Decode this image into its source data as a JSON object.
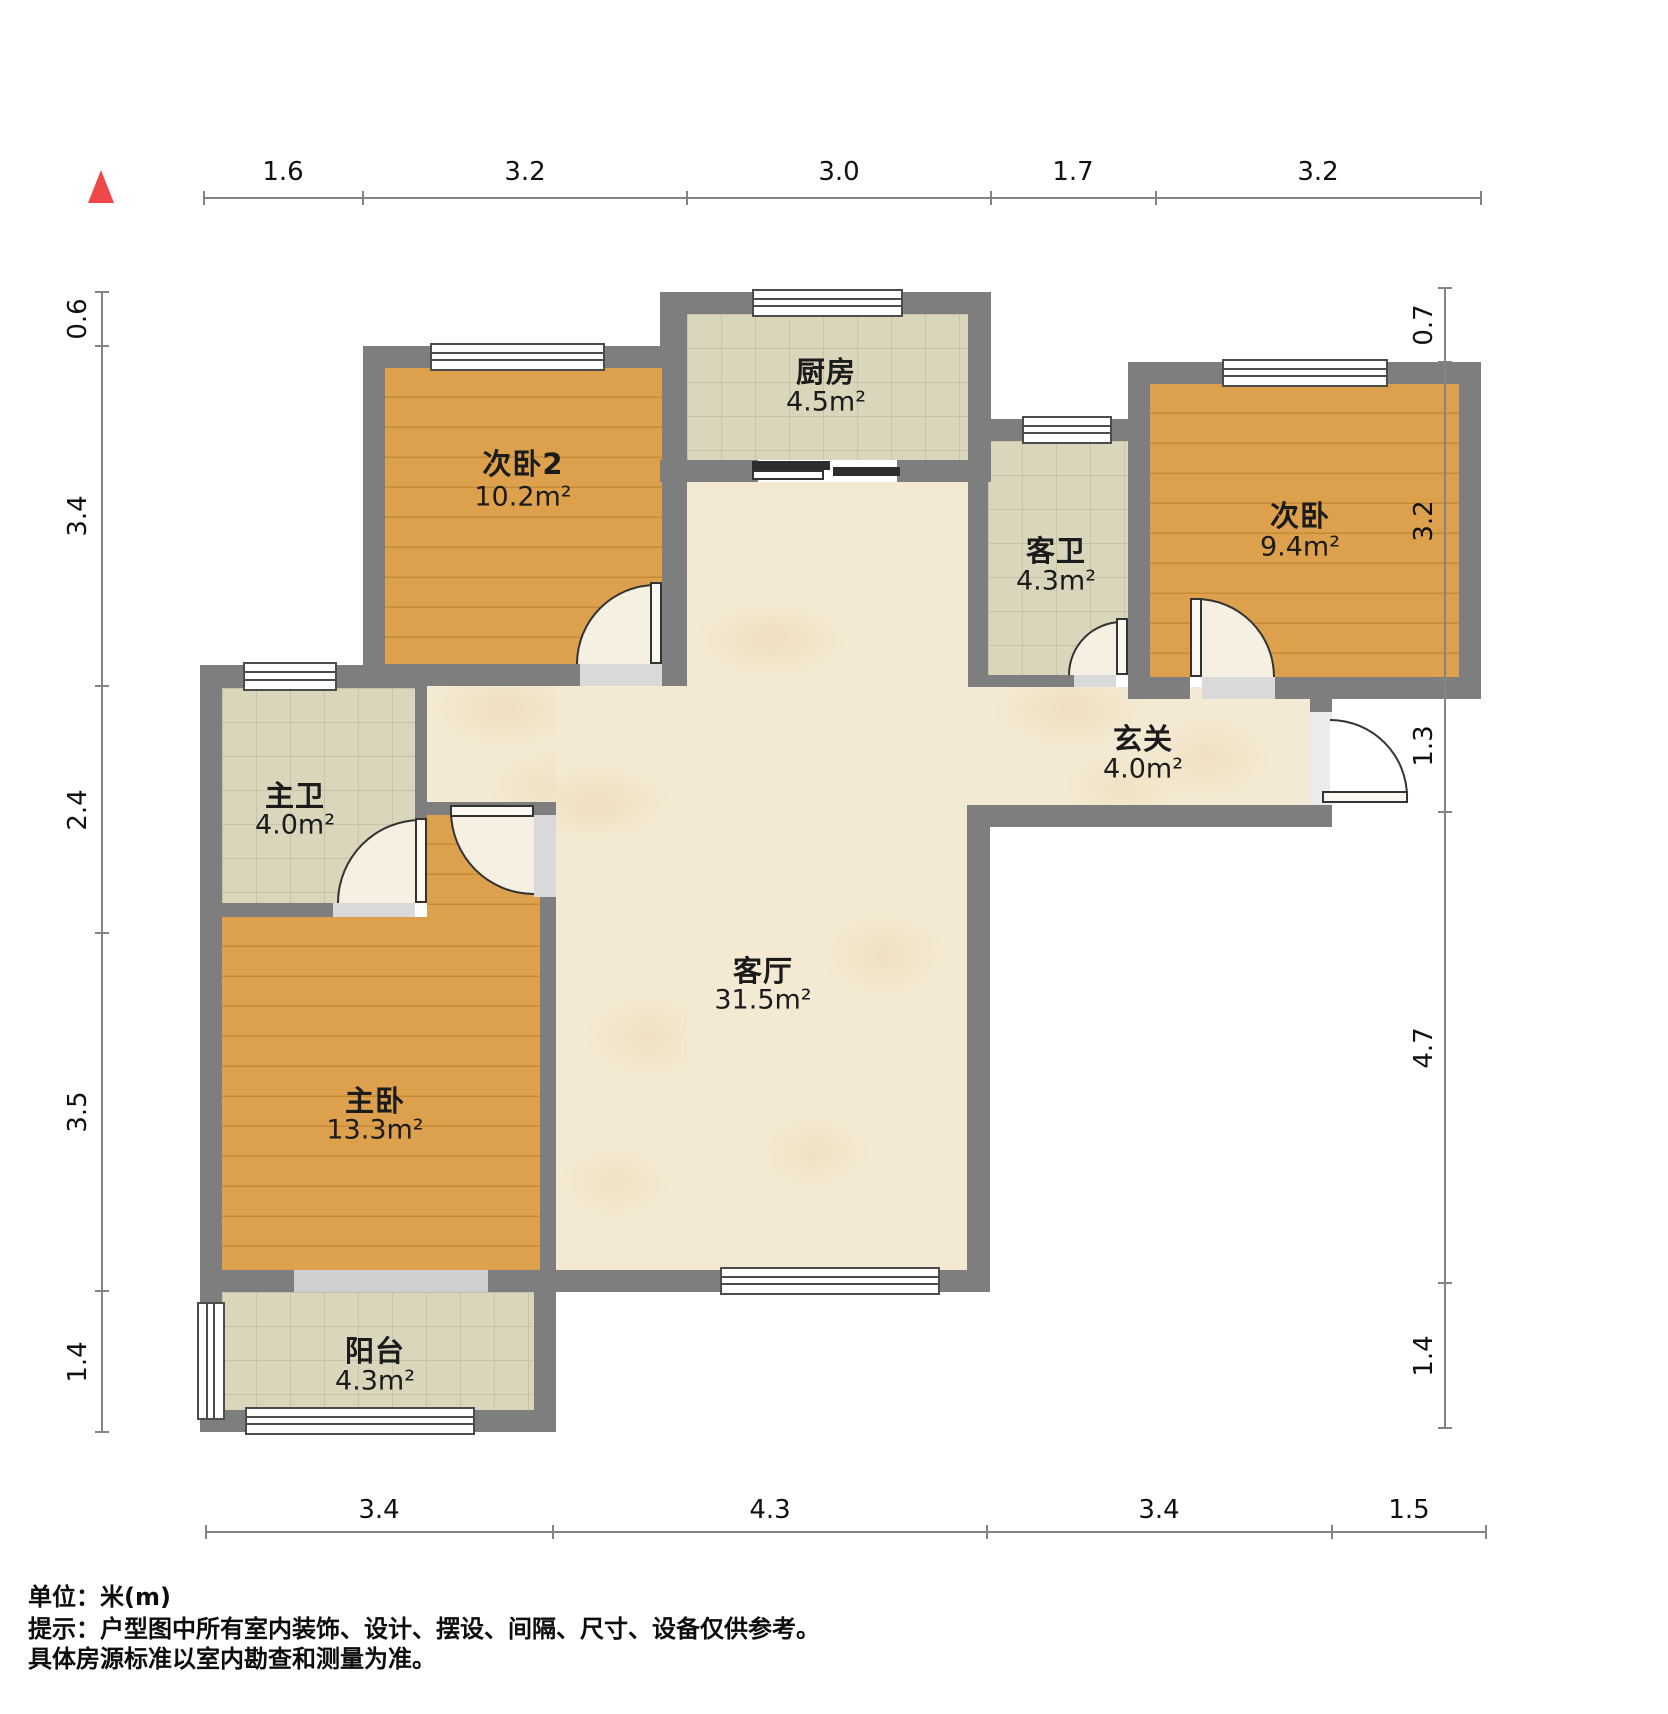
{
  "plan": {
    "unit_note": "单位：米(m)",
    "tip_line1": "提示：户型图中所有室内装饰、设计、摆设、间隔、尺寸、设备仅供参考。",
    "tip_line2": "具体房源标准以室内勘查和测量为准。"
  },
  "rooms": [
    {
      "id": "kitchen",
      "name": "厨房",
      "area": "4.5m²"
    },
    {
      "id": "bedroom2",
      "name": "次卧2",
      "area": "10.2m²"
    },
    {
      "id": "guest-bath",
      "name": "客卫",
      "area": "4.3m²"
    },
    {
      "id": "bedroom",
      "name": "次卧",
      "area": "9.4m²"
    },
    {
      "id": "foyer",
      "name": "玄关",
      "area": "4.0m²"
    },
    {
      "id": "master-bath",
      "name": "主卫",
      "area": "4.0m²"
    },
    {
      "id": "living-room",
      "name": "客厅",
      "area": "31.5m²"
    },
    {
      "id": "master-bedroom",
      "name": "主卧",
      "area": "13.3m²"
    },
    {
      "id": "balcony",
      "name": "阳台",
      "area": "4.3m²"
    }
  ],
  "dims": {
    "top": [
      "1.6",
      "3.2",
      "3.0",
      "1.7",
      "3.2"
    ],
    "bottom": [
      "3.4",
      "4.3",
      "3.4",
      "1.5"
    ],
    "left": [
      "0.6",
      "3.4",
      "2.4",
      "3.5",
      "1.4"
    ],
    "right": [
      "0.7",
      "3.2",
      "1.3",
      "4.7",
      "1.4"
    ]
  },
  "icons": {
    "north_marker": "north-arrow"
  },
  "colors": {
    "wall": "#7e7e7e",
    "wood_floor": "#d89a43",
    "tile_floor": "#d9d6bc",
    "marble_floor": "#f4ead4",
    "north_arrow": "#ef4848",
    "text": "#1b1b1b"
  }
}
